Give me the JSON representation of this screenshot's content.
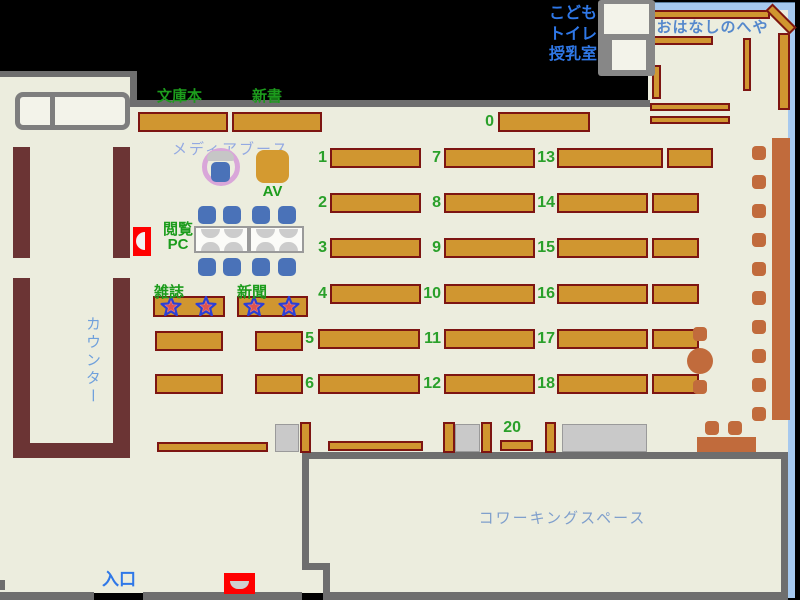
{
  "title": "library-floor-map",
  "palette": {
    "background": "#000000",
    "floor": "#ECEDDE",
    "wall_gray": "#6E6E6E",
    "shelf_fill": "#D09630",
    "shelf_border": "#7D1512",
    "counter_brown": "#6B3434",
    "storyroom_border_blue": "#A6C9EF",
    "furniture_sienna": "#C16B3C",
    "chair_blue": "#4A72B8",
    "green_text": "#1C9C1C",
    "blue_text": "#2F78E8",
    "light_blue_text": "#6FA0DC",
    "red_marker": "#FF0000",
    "media_ring_plum": "#D9A6D9"
  },
  "labels": {
    "kids": "こども",
    "toilet": "トイレ",
    "nursing": "授乳室",
    "storyroom": "おはなしのへや",
    "paperback": "文庫本",
    "new_books": "新書",
    "media_booth": "メディアブース",
    "av": "AV",
    "pc_line1": "閲覧",
    "pc_line2": "PC",
    "magazine": "雑誌",
    "newspaper": "新聞",
    "counter": "カウンター",
    "entrance": "入口",
    "coworking": "コワーキングスペース"
  },
  "geometry": {
    "floors": [
      {
        "x": 0,
        "y": 77,
        "w": 137,
        "h": 516
      },
      {
        "x": 137,
        "y": 107,
        "w": 651,
        "h": 486
      },
      {
        "x": 648,
        "y": 10,
        "w": 140,
        "h": 100
      }
    ],
    "walls": [
      {
        "x": 0,
        "y": 71,
        "w": 137,
        "h": 6
      },
      {
        "x": 130,
        "y": 71,
        "w": 7,
        "h": 36
      },
      {
        "x": 137,
        "y": 100,
        "w": 513,
        "h": 7
      },
      {
        "x": 0,
        "y": 592,
        "w": 94,
        "h": 8
      },
      {
        "x": 143,
        "y": 592,
        "w": 159,
        "h": 8
      },
      {
        "x": 302,
        "y": 452,
        "w": 486,
        "h": 7
      },
      {
        "x": 302,
        "y": 452,
        "w": 7,
        "h": 113
      },
      {
        "x": 302,
        "y": 563,
        "w": 28,
        "h": 7
      },
      {
        "x": 323,
        "y": 563,
        "w": 7,
        "h": 30
      },
      {
        "x": 323,
        "y": 592,
        "w": 465,
        "h": 8
      },
      {
        "x": 781,
        "y": 452,
        "w": 7,
        "h": 148
      },
      {
        "x": 0,
        "y": 580,
        "w": 5,
        "h": 10
      }
    ],
    "blue_borders": [
      {
        "x": 648,
        "y": 2,
        "w": 147,
        "h": 8
      },
      {
        "x": 788,
        "y": 2,
        "w": 7,
        "h": 596
      }
    ],
    "counter": [
      {
        "x": 13,
        "y": 147,
        "w": 17,
        "h": 111
      },
      {
        "x": 113,
        "y": 147,
        "w": 17,
        "h": 111
      },
      {
        "x": 13,
        "y": 278,
        "w": 17,
        "h": 180
      },
      {
        "x": 113,
        "y": 278,
        "w": 17,
        "h": 167
      },
      {
        "x": 13,
        "y": 443,
        "w": 117,
        "h": 15
      }
    ],
    "shelves": [
      {
        "x": 138,
        "y": 112,
        "w": 90,
        "h": 20
      },
      {
        "x": 232,
        "y": 112,
        "w": 90,
        "h": 20
      },
      {
        "x": 498,
        "y": 112,
        "w": 92,
        "h": 20
      },
      {
        "x": 330,
        "y": 148,
        "w": 91,
        "h": 20
      },
      {
        "x": 330,
        "y": 193,
        "w": 91,
        "h": 20
      },
      {
        "x": 330,
        "y": 238,
        "w": 91,
        "h": 20
      },
      {
        "x": 330,
        "y": 284,
        "w": 91,
        "h": 20
      },
      {
        "x": 318,
        "y": 329,
        "w": 102,
        "h": 20
      },
      {
        "x": 318,
        "y": 374,
        "w": 102,
        "h": 20
      },
      {
        "x": 444,
        "y": 148,
        "w": 91,
        "h": 20
      },
      {
        "x": 444,
        "y": 193,
        "w": 91,
        "h": 20
      },
      {
        "x": 444,
        "y": 238,
        "w": 91,
        "h": 20
      },
      {
        "x": 444,
        "y": 284,
        "w": 91,
        "h": 20
      },
      {
        "x": 444,
        "y": 329,
        "w": 91,
        "h": 20
      },
      {
        "x": 444,
        "y": 374,
        "w": 91,
        "h": 20
      },
      {
        "x": 557,
        "y": 148,
        "w": 106,
        "h": 20
      },
      {
        "x": 557,
        "y": 193,
        "w": 91,
        "h": 20
      },
      {
        "x": 557,
        "y": 238,
        "w": 91,
        "h": 20
      },
      {
        "x": 557,
        "y": 284,
        "w": 91,
        "h": 20
      },
      {
        "x": 557,
        "y": 329,
        "w": 91,
        "h": 20
      },
      {
        "x": 557,
        "y": 374,
        "w": 91,
        "h": 20
      },
      {
        "x": 667,
        "y": 148,
        "w": 46,
        "h": 20
      },
      {
        "x": 652,
        "y": 193,
        "w": 47,
        "h": 20
      },
      {
        "x": 652,
        "y": 238,
        "w": 47,
        "h": 20
      },
      {
        "x": 652,
        "y": 284,
        "w": 47,
        "h": 20
      },
      {
        "x": 652,
        "y": 329,
        "w": 47,
        "h": 20
      },
      {
        "x": 652,
        "y": 374,
        "w": 47,
        "h": 20
      },
      {
        "x": 155,
        "y": 331,
        "w": 68,
        "h": 20
      },
      {
        "x": 255,
        "y": 331,
        "w": 48,
        "h": 20
      },
      {
        "x": 155,
        "y": 374,
        "w": 68,
        "h": 20
      },
      {
        "x": 255,
        "y": 374,
        "w": 48,
        "h": 20
      },
      {
        "x": 153,
        "y": 296,
        "w": 72,
        "h": 21
      },
      {
        "x": 237,
        "y": 296,
        "w": 71,
        "h": 21
      },
      {
        "x": 157,
        "y": 442,
        "w": 111,
        "h": 10
      },
      {
        "x": 328,
        "y": 441,
        "w": 95,
        "h": 10
      },
      {
        "x": 500,
        "y": 440,
        "w": 33,
        "h": 11
      },
      {
        "x": 300,
        "y": 422,
        "w": 11,
        "h": 31
      },
      {
        "x": 443,
        "y": 422,
        "w": 12,
        "h": 31
      },
      {
        "x": 481,
        "y": 422,
        "w": 11,
        "h": 31
      },
      {
        "x": 545,
        "y": 422,
        "w": 11,
        "h": 31
      },
      {
        "x": 650,
        "y": 10,
        "w": 120,
        "h": 9
      },
      {
        "x": 650,
        "y": 36,
        "w": 63,
        "h": 9
      },
      {
        "x": 652,
        "y": 65,
        "w": 9,
        "h": 34
      },
      {
        "x": 743,
        "y": 38,
        "w": 8,
        "h": 53
      },
      {
        "x": 778,
        "y": 33,
        "w": 12,
        "h": 77
      },
      {
        "x": 650,
        "y": 103,
        "w": 80,
        "h": 8
      },
      {
        "x": 650,
        "y": 116,
        "w": 80,
        "h": 8
      },
      {
        "x": 764,
        "y": 14,
        "w": 34,
        "h": 10,
        "rot": 45
      }
    ],
    "gray_boxes": [
      {
        "x": 275,
        "y": 424,
        "w": 24,
        "h": 28
      },
      {
        "x": 455,
        "y": 424,
        "w": 25,
        "h": 28
      },
      {
        "x": 562,
        "y": 424,
        "w": 85,
        "h": 28
      }
    ],
    "sienna_blocks": [
      {
        "x": 772,
        "y": 138,
        "w": 18,
        "h": 282
      },
      {
        "x": 697,
        "y": 437,
        "w": 59,
        "h": 15
      }
    ],
    "stools": [
      [
        752,
        146
      ],
      [
        752,
        175
      ],
      [
        752,
        204
      ],
      [
        752,
        233
      ],
      [
        752,
        262
      ],
      [
        752,
        291
      ],
      [
        752,
        320
      ],
      [
        752,
        349
      ],
      [
        752,
        378
      ],
      [
        752,
        407
      ],
      [
        693,
        327
      ],
      [
        693,
        380
      ],
      [
        705,
        421
      ],
      [
        728,
        421
      ]
    ],
    "round_table": {
      "x": 687,
      "y": 348,
      "w": 26,
      "h": 26
    },
    "pc_chairs": [
      [
        198,
        206
      ],
      [
        223,
        206
      ],
      [
        252,
        206
      ],
      [
        278,
        206
      ],
      [
        198,
        258
      ],
      [
        223,
        258
      ],
      [
        252,
        258
      ],
      [
        278,
        258
      ]
    ],
    "shelf_numbers": [
      {
        "label": "0",
        "right": 494,
        "y": 112
      },
      {
        "label": "1",
        "right": 327,
        "y": 148
      },
      {
        "label": "2",
        "right": 327,
        "y": 193
      },
      {
        "label": "3",
        "right": 327,
        "y": 238
      },
      {
        "label": "4",
        "right": 327,
        "y": 284
      },
      {
        "label": "5",
        "right": 314,
        "y": 329
      },
      {
        "label": "6",
        "right": 314,
        "y": 374
      },
      {
        "label": "7",
        "right": 441,
        "y": 148
      },
      {
        "label": "8",
        "right": 441,
        "y": 193
      },
      {
        "label": "9",
        "right": 441,
        "y": 238
      },
      {
        "label": "10",
        "right": 441,
        "y": 284
      },
      {
        "label": "11",
        "right": 441,
        "y": 329
      },
      {
        "label": "12",
        "right": 441,
        "y": 374
      },
      {
        "label": "13",
        "right": 555,
        "y": 148
      },
      {
        "label": "14",
        "right": 555,
        "y": 193
      },
      {
        "label": "15",
        "right": 555,
        "y": 238
      },
      {
        "label": "16",
        "right": 555,
        "y": 284
      },
      {
        "label": "17",
        "right": 555,
        "y": 329
      },
      {
        "label": "18",
        "right": 555,
        "y": 374
      },
      {
        "label": "20",
        "right": 521,
        "y": 418
      }
    ],
    "stars": [
      {
        "cx": 171,
        "cy": 307
      },
      {
        "cx": 206,
        "cy": 307
      },
      {
        "cx": 254,
        "cy": 307
      },
      {
        "cx": 289,
        "cy": 307
      }
    ]
  }
}
